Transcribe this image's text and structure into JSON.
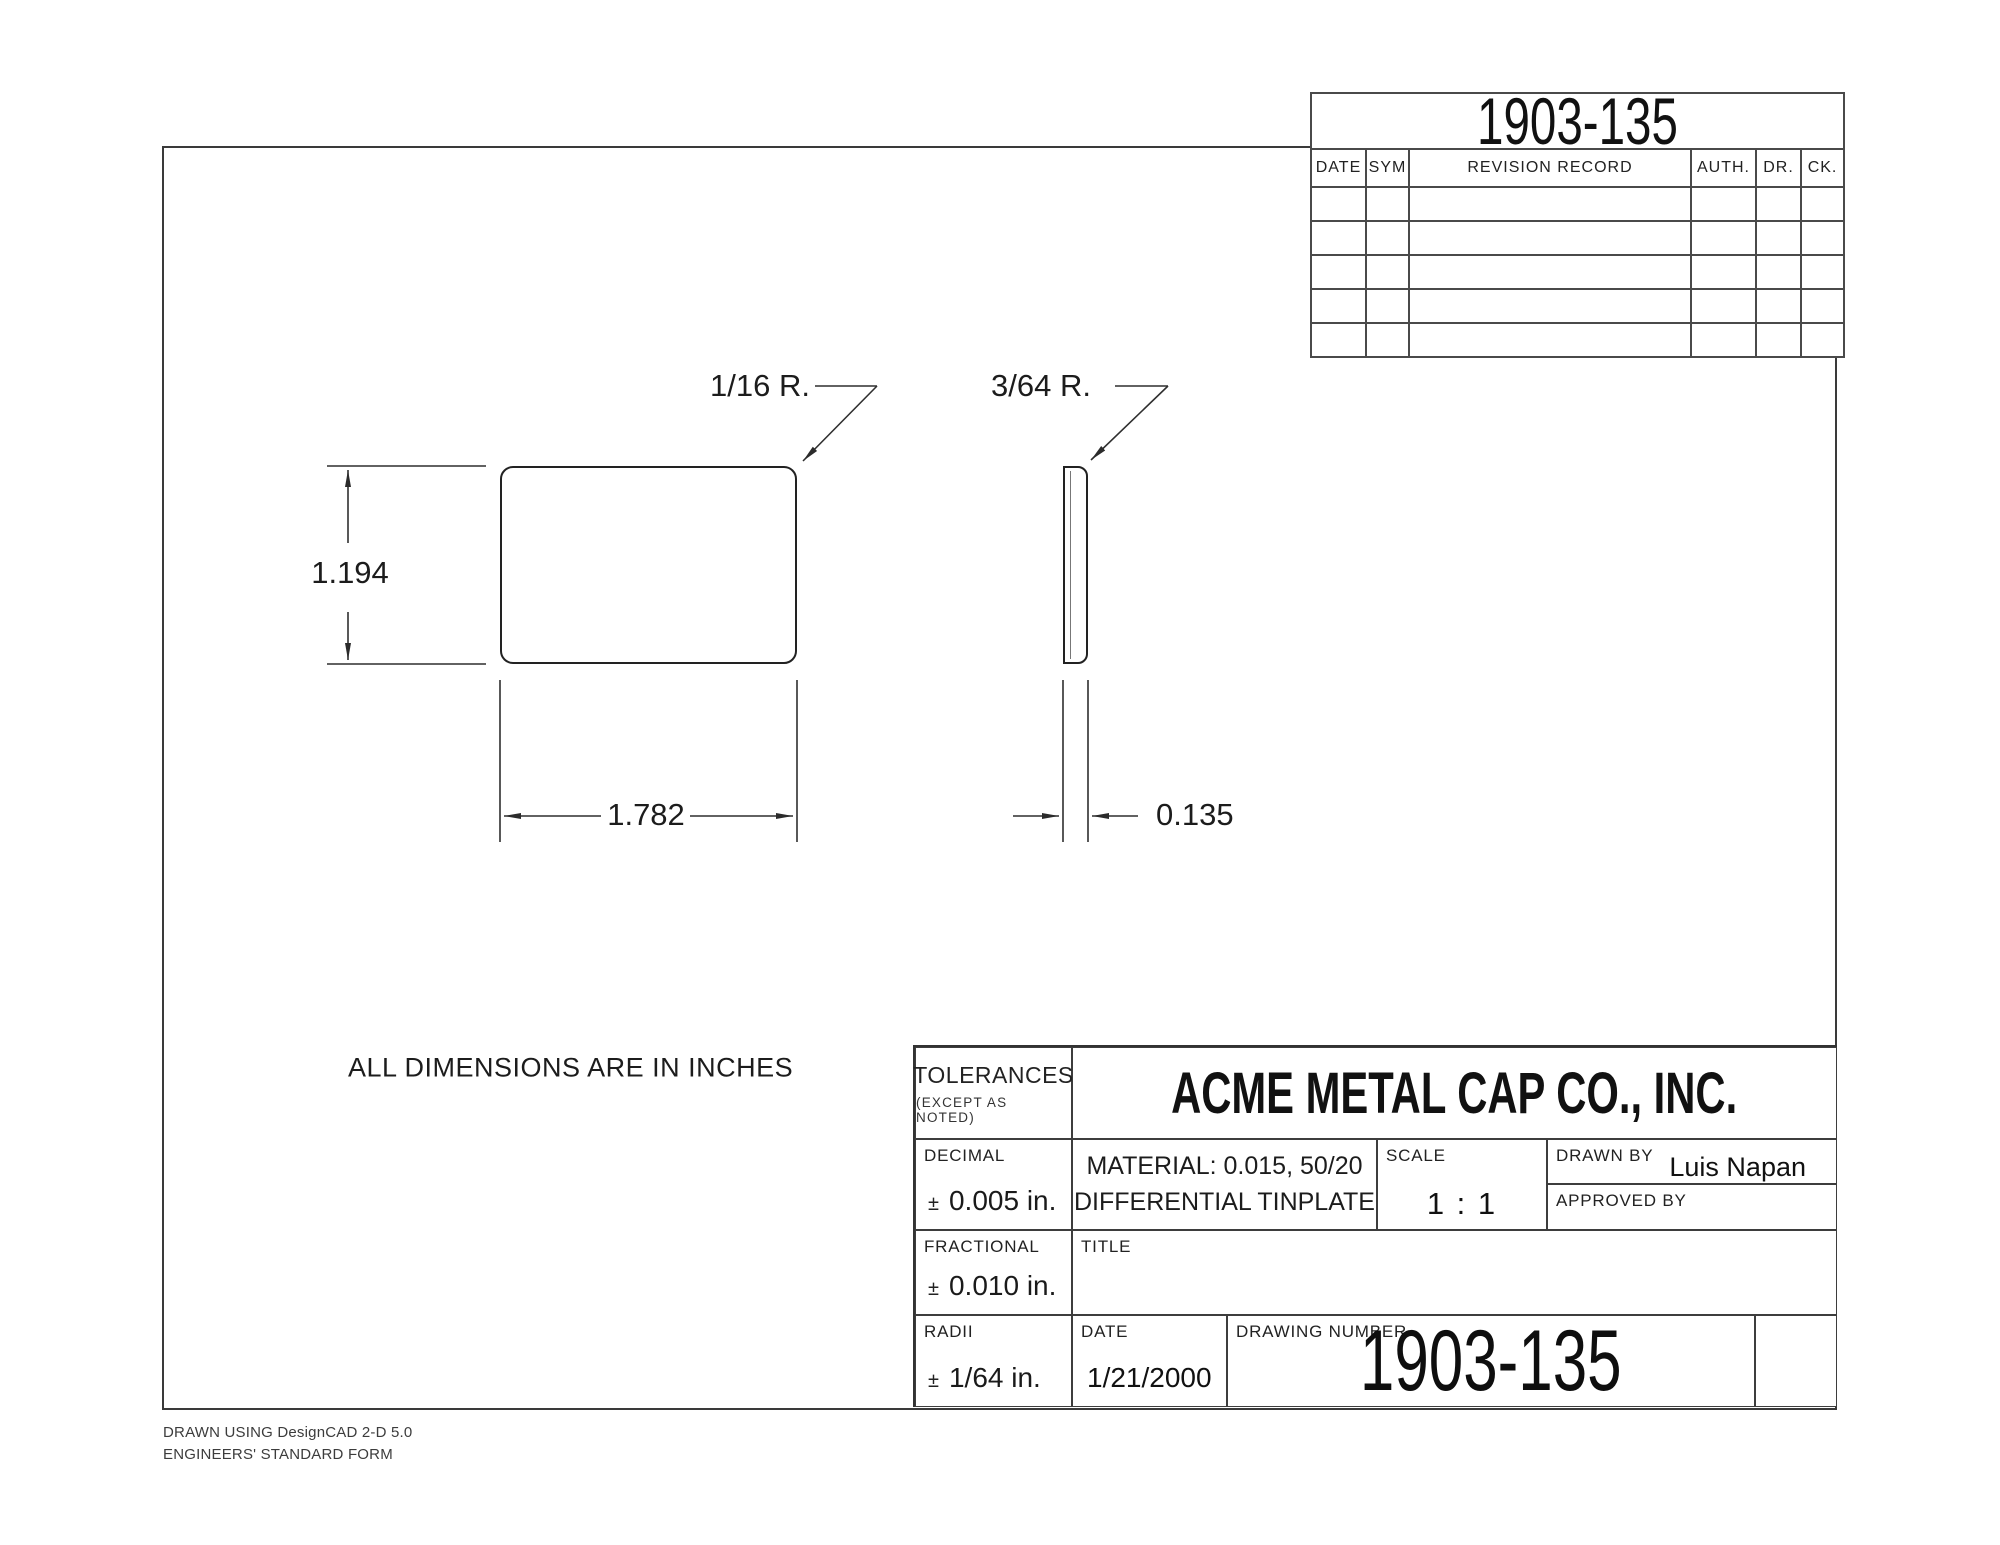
{
  "revision_table": {
    "title": "1903-135",
    "columns": [
      "DATE",
      "SYM",
      "REVISION RECORD",
      "AUTH.",
      "DR.",
      "CK."
    ],
    "empty_row_count": 5
  },
  "drawing": {
    "note": "ALL DIMENSIONS ARE IN INCHES",
    "front_view": {
      "height_label": "1.194",
      "width_label": "1.782",
      "corner_radius_label": "1/16 R."
    },
    "side_view": {
      "thickness_label": "0.135",
      "corner_radius_label": "3/64 R."
    }
  },
  "title_block": {
    "tolerances": {
      "label": "TOLERANCES",
      "sub": "(EXCEPT AS NOTED)"
    },
    "company": "ACME METAL CAP CO., INC.",
    "decimal": {
      "label": "DECIMAL",
      "pm": "±",
      "value": "0.005 in."
    },
    "material": {
      "line1": "MATERIAL: 0.015, 50/20",
      "line2": "DIFFERENTIAL TINPLATE"
    },
    "scale": {
      "label": "SCALE",
      "value": "1 : 1"
    },
    "drawn_by": {
      "label": "DRAWN BY",
      "value": "Luis Napan"
    },
    "approved_by": {
      "label": "APPROVED BY",
      "value": ""
    },
    "fractional": {
      "label": "FRACTIONAL",
      "pm": "±",
      "value": "0.010 in."
    },
    "title_cell": {
      "label": "TITLE",
      "value": ""
    },
    "radii": {
      "label": "RADII",
      "pm": "±",
      "value": "1/64 in."
    },
    "date": {
      "label": "DATE",
      "value": "1/21/2000"
    },
    "drawing_number": {
      "label": "DRAWING NUMBER",
      "value": "1903-135"
    }
  },
  "footer": {
    "line1": "DRAWN USING DesignCAD 2-D 5.0",
    "line2": "ENGINEERS' STANDARD FORM"
  }
}
